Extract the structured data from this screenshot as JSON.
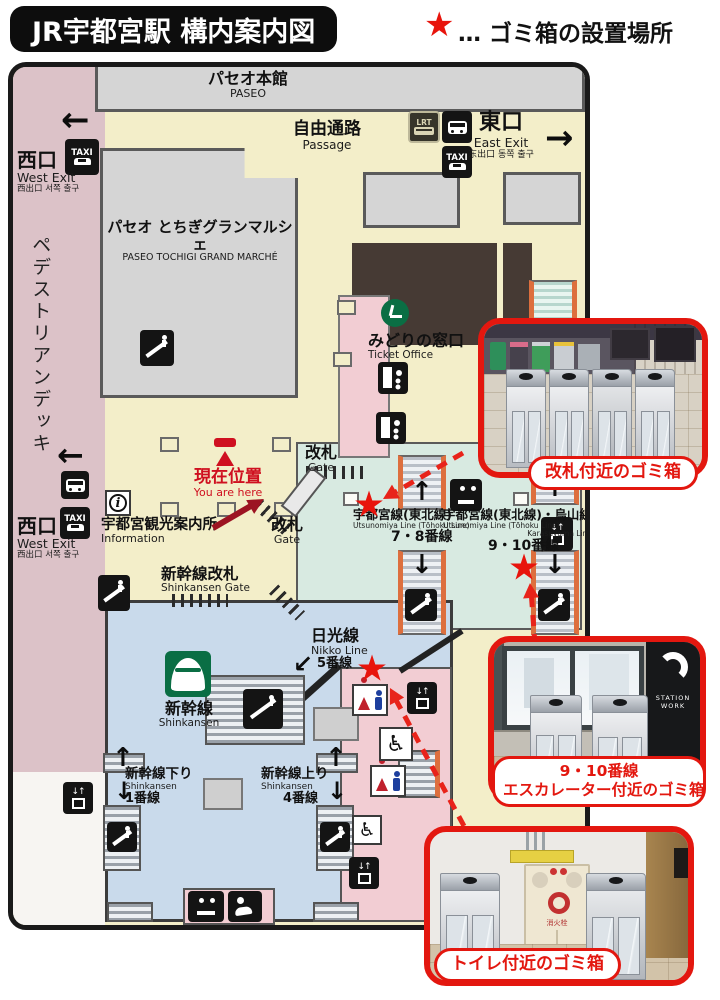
{
  "header": {
    "title": "JR宇都宮駅 構内案内図",
    "legend_star": "★",
    "legend_text": "… ゴミ箱の設置場所"
  },
  "map": {
    "labels": {
      "paseo_hall_ja": "パセオ本館",
      "paseo_hall_en": "PASEO",
      "passage_ja": "自由通路",
      "passage_en": "Passage",
      "grand_marche_ja": "パセオ とちぎグランマルシェ",
      "grand_marche_en": "PASEO TOCHIGI GRAND MARCHÉ",
      "pedestrian_deck": "ペデストリアンデッキ",
      "west_exit_ja": "西口",
      "west_exit_en": "West Exit",
      "west_exit_sub": "西出口  서쪽 출구",
      "east_exit_ja": "東口",
      "east_exit_en": "East Exit",
      "east_exit_sub": "东出口  동쪽 출구",
      "ticket_office_ja": "みどりの窓口",
      "ticket_office_en": "Ticket Office",
      "you_are_here_ja": "現在位置",
      "you_are_here_en": "You are here",
      "gate_ja": "改札",
      "gate_en": "Gate",
      "info_ja": "宇都宮観光案内所",
      "info_en": "Information",
      "shinkansen_gate_ja": "新幹線改札",
      "shinkansen_gate_en": "Shinkansen Gate",
      "line78_ja": "宇都宮線(東北線)",
      "line78_en": "Utsunomiya Line (Tōhoku Line)",
      "line78_platform": "7・8番線",
      "line910_ja": "宇都宮線(東北線)・烏山線",
      "line910_en": "Utsunomiya Line (Tōhoku Line)",
      "line910_en2": "Karasuyama Line",
      "line910_platform": "9・10番線",
      "nikko_ja": "日光線",
      "nikko_en": "Nikko Line",
      "nikko_platform": "5番線",
      "shinkansen_ja": "新幹線",
      "shinkansen_en": "Shinkansen",
      "shinkansen_down_ja": "新幹線下り",
      "shinkansen_down_en": "Shinkansen",
      "shinkansen_down_platform": "1番線",
      "shinkansen_up_ja": "新幹線上り",
      "shinkansen_up_en": "Shinkansen",
      "shinkansen_up_platform": "4番線",
      "taxi": "TAXI",
      "lrt": "LRT",
      "arrow_left": "←",
      "arrow_right": "→",
      "arrow_up": "↑",
      "arrow_down": "↓",
      "arrow_downleft": "↙",
      "elevator_arrows": "↓↑",
      "wheelchair": "♿",
      "info_i": "i"
    }
  },
  "photos": [
    {
      "label": "改札付近のゴミ箱"
    },
    {
      "label_line1": "9・10番線",
      "label_line2": "エスカレーター付近のゴミ箱",
      "sign_text": "STATION WORK"
    },
    {
      "label": "トイレ付近のゴミ箱",
      "cabinet_text": "消火栓"
    }
  ],
  "colors": {
    "accent_red": "#e3170f",
    "map_yellow": "#f3eec9",
    "deck_pink": "#dcc2c8",
    "paid_teal": "#d8eae1",
    "shinkansen_blue": "#c9daeb",
    "zone_pink": "#f2cdd3",
    "escalator_orange": "#dd6f3e",
    "block_gray": "#d5d5d5",
    "block_brown": "#463a34"
  }
}
